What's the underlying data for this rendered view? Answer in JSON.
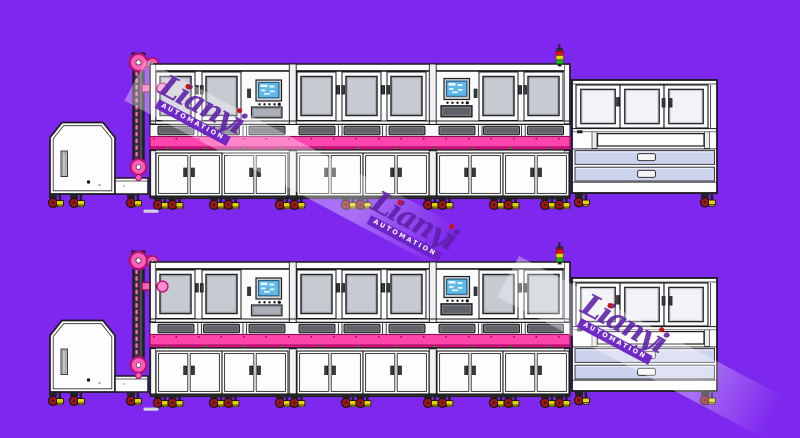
{
  "canvas": {
    "width": 800,
    "height": 438
  },
  "scene": "Two identical side-elevation engineering drawings of an automated production line on a purple canvas",
  "colors": {
    "background": "#7E27EE",
    "line_pink": "#FF44AD",
    "line_pink_dark": "#E3118F",
    "sprocket_pink": "#FF5FB8",
    "sprocket_ring": "#B01371",
    "screen_blue": "#5FB8E8",
    "stack_red": "#E21212",
    "stack_yellow": "#EED500",
    "stack_green": "#17B817",
    "wheel_red": "#9E1616",
    "foot_yellow": "#E3D400",
    "drawer_lavender": "#CDD3EC",
    "glass_gray": "#C6CBD2",
    "watermark_band": "rgba(255,255,255,0.34)",
    "brand_purple": "#5D1FA8",
    "ribbon_purple": "#6B21C8",
    "brand_dot_red": "#C81414"
  },
  "rows": [
    {
      "name": "production-line-top",
      "top_px": 0
    },
    {
      "name": "production-line-bottom",
      "top_px": 198
    }
  ],
  "machine": {
    "components": [
      "hopper-feeder",
      "lift-conveyor",
      "process-module-1",
      "process-module-2",
      "process-module-3",
      "end-station"
    ],
    "module_windows": [
      2,
      3,
      2
    ],
    "hmi_screens": 2,
    "stack_light": [
      "red",
      "yellow",
      "green"
    ],
    "end_station": {
      "windows": 3,
      "drawers": 2
    },
    "lower_cabinet_doors": 12
  },
  "watermark": {
    "brand": "Lianyi",
    "subtitle": "AUTOMATION",
    "instances": 3,
    "angle_deg": 28
  }
}
